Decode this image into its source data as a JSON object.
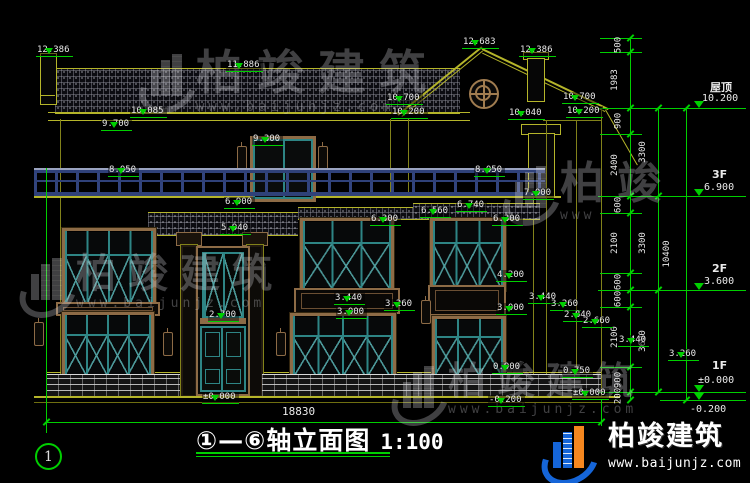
{
  "title_block": {
    "title": "①—⑥轴立面图",
    "scale": "1:100"
  },
  "ground_dim": "18830",
  "axis_bubble": "1",
  "brand_footer": {
    "brand": "柏竣建筑",
    "url": "www.baijunjz.com"
  },
  "colors": {
    "annotation_green": "#00cf00",
    "wall_yellow": "#b5b52a",
    "frame_brown": "#8d6b46",
    "sash_teal": "#2e8585",
    "logo_blue": "#1565d8",
    "logo_orange": "#f5871f"
  },
  "watermarks": [
    {
      "brand": "柏竣建筑",
      "url": "www.baijunjz.com",
      "x": 142,
      "y": 50,
      "fs": 47,
      "us": 14
    },
    {
      "brand": "柏竣建筑",
      "url": "www.baijunjz.com",
      "x": 22,
      "y": 254,
      "fs": 40,
      "us": 13
    },
    {
      "brand": "柏竣建筑",
      "url": "www.baijunjz.com",
      "x": 394,
      "y": 362,
      "fs": 38,
      "us": 13
    },
    {
      "brand": "柏竣",
      "url": "www",
      "x": 506,
      "y": 162,
      "fs": 44,
      "us": 13
    }
  ],
  "elevation_marks": [
    {
      "t": "12.386",
      "x": 36,
      "y": 37
    },
    {
      "t": "11.886",
      "x": 226,
      "y": 52
    },
    {
      "t": "10.085",
      "x": 130,
      "y": 98
    },
    {
      "t": "9.700",
      "x": 101,
      "y": 111
    },
    {
      "t": "12.683",
      "x": 462,
      "y": 29
    },
    {
      "t": "12.386",
      "x": 519,
      "y": 37
    },
    {
      "t": "10.700",
      "x": 386,
      "y": 85
    },
    {
      "t": "10.200",
      "x": 391,
      "y": 99
    },
    {
      "t": "10.700",
      "x": 562,
      "y": 84
    },
    {
      "t": "10.200",
      "x": 566,
      "y": 98
    },
    {
      "t": "10.040",
      "x": 508,
      "y": 100
    },
    {
      "t": "9.300",
      "x": 252,
      "y": 126
    },
    {
      "t": "8.050",
      "x": 108,
      "y": 157
    },
    {
      "t": "8.050",
      "x": 474,
      "y": 157
    },
    {
      "t": "6.900",
      "x": 224,
      "y": 189
    },
    {
      "t": "5.940",
      "x": 220,
      "y": 215
    },
    {
      "t": "6.560",
      "x": 420,
      "y": 198
    },
    {
      "t": "6.740",
      "x": 456,
      "y": 192
    },
    {
      "t": "7.000",
      "x": 523,
      "y": 180
    },
    {
      "t": "6.300",
      "x": 370,
      "y": 206
    },
    {
      "t": "6.300",
      "x": 492,
      "y": 206
    },
    {
      "t": "4.200",
      "x": 496,
      "y": 262
    },
    {
      "t": "3.440",
      "x": 334,
      "y": 285
    },
    {
      "t": "3.260",
      "x": 384,
      "y": 291
    },
    {
      "t": "3.000",
      "x": 336,
      "y": 299
    },
    {
      "t": "3.000",
      "x": 496,
      "y": 295
    },
    {
      "t": "2.700",
      "x": 208,
      "y": 302
    },
    {
      "t": "3.440",
      "x": 528,
      "y": 284
    },
    {
      "t": "3.260",
      "x": 550,
      "y": 291
    },
    {
      "t": "2.840",
      "x": 563,
      "y": 302
    },
    {
      "t": "2.660",
      "x": 582,
      "y": 308
    },
    {
      "t": "3.440",
      "x": 618,
      "y": 327
    },
    {
      "t": "3.260",
      "x": 668,
      "y": 341
    },
    {
      "t": "0.900",
      "x": 492,
      "y": 354
    },
    {
      "t": "0.750",
      "x": 562,
      "y": 358
    },
    {
      "t": "±0.000",
      "x": 202,
      "y": 384
    },
    {
      "t": "±0.000",
      "x": 572,
      "y": 380
    },
    {
      "t": "-0.200",
      "x": 488,
      "y": 387
    }
  ],
  "levels": [
    {
      "name": "屋顶",
      "elev": "10.200",
      "y": 108,
      "nx": 710,
      "ny": 79,
      "ex": 702,
      "ey": 93
    },
    {
      "name": "3F",
      "elev": "6.900",
      "y": 196,
      "nx": 712,
      "ny": 168,
      "ex": 704,
      "ey": 182
    },
    {
      "name": "2F",
      "elev": "3.600",
      "y": 290,
      "nx": 712,
      "ny": 262,
      "ex": 704,
      "ey": 276
    },
    {
      "name": "1F",
      "elev": "±0.000",
      "y": 392,
      "nx": 712,
      "ny": 359,
      "ex": 698,
      "ey": 375
    },
    {
      "name": "",
      "elev": "-0.200",
      "y": 400,
      "nx": 0,
      "ny": 0,
      "ex": 690,
      "ey": 404
    }
  ],
  "dim_chains": {
    "inner": {
      "x": 630,
      "ticks": [
        38,
        52,
        108,
        134,
        196,
        213,
        273,
        290,
        307,
        367,
        392,
        400
      ],
      "labels": [
        "500",
        "1983",
        "900",
        "2400",
        "600",
        "2100",
        "600",
        "600",
        "2100",
        "900",
        "200"
      ]
    },
    "middle": {
      "x": 658,
      "ticks": [
        108,
        196,
        290,
        392
      ],
      "labels": [
        "3300",
        "3300",
        "3600"
      ]
    },
    "outer": {
      "x": 686,
      "ticks": [
        108,
        400
      ],
      "labels": [
        "10400"
      ]
    }
  }
}
